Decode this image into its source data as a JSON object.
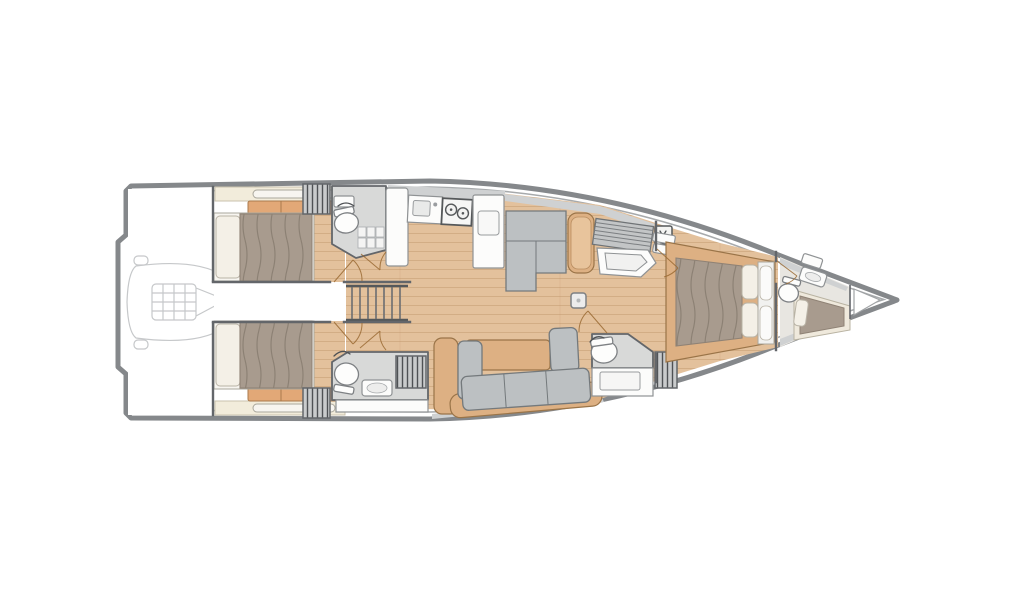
{
  "diagram": {
    "kind": "sailing-yacht-interior-floorplan",
    "orientation": {
      "bow": "right",
      "stern": "left"
    },
    "background": "#ffffff",
    "visible_text": [],
    "elements": [
      "hull-outline",
      "swim-platform-transom",
      "tender-garage-with-dinghy",
      "aft-cabin-port-double-bed",
      "aft-cabin-starboard-double-bed",
      "aft-head-port-toilet",
      "aft-head-starboard-toilet-shower",
      "companionway-stairs",
      "galley-sink-stove-fridge",
      "salon-settee-with-table",
      "nav-station-chart-table",
      "salon-l-sofa-with-table",
      "mast-compression-post",
      "ensuite-head-toilet-shower",
      "owners-cabin-island-bed",
      "bow-head-toilet-sink",
      "forepeak-crew-berth",
      "anchor-locker"
    ],
    "icons": [
      "toilet-icon",
      "sink-icon",
      "stove-burner-icon",
      "faucet-icon",
      "shower-door-icon",
      "hatch-symbol-icon",
      "mast-post-icon",
      "dinghy-outline-icon",
      "stairs-icon",
      "door-swing-icon"
    ]
  },
  "palette": {
    "hull-stroke": "#85888b",
    "hull-inner": "#a7aaac",
    "wall": "#63666a",
    "wood": "#e3c19c",
    "wood-line": "#b98d60",
    "wood-frame": "#ddb083",
    "wood-frame-edge": "#9a7448",
    "cushion-tan": "#e2a877",
    "cushion-tan-edge": "#a97a4c",
    "bed-taupe": "#a89b8e",
    "bed-dark": "#8f8275",
    "pillow": "#f4f0e7",
    "sofa-gray": "#bcc0c2",
    "sofa-gray-dark": "#74797c",
    "furniture-white": "#fcfcfb",
    "furniture-stroke": "#8f9294",
    "head-floor": "#d8d9d8",
    "deck-gray": "#cfd1d2",
    "shelf-cream": "#f2ecdb",
    "bow-floor": "#e8e6e1",
    "ghost": "#c6c8ca",
    "door-arc": "#9a6a33"
  }
}
